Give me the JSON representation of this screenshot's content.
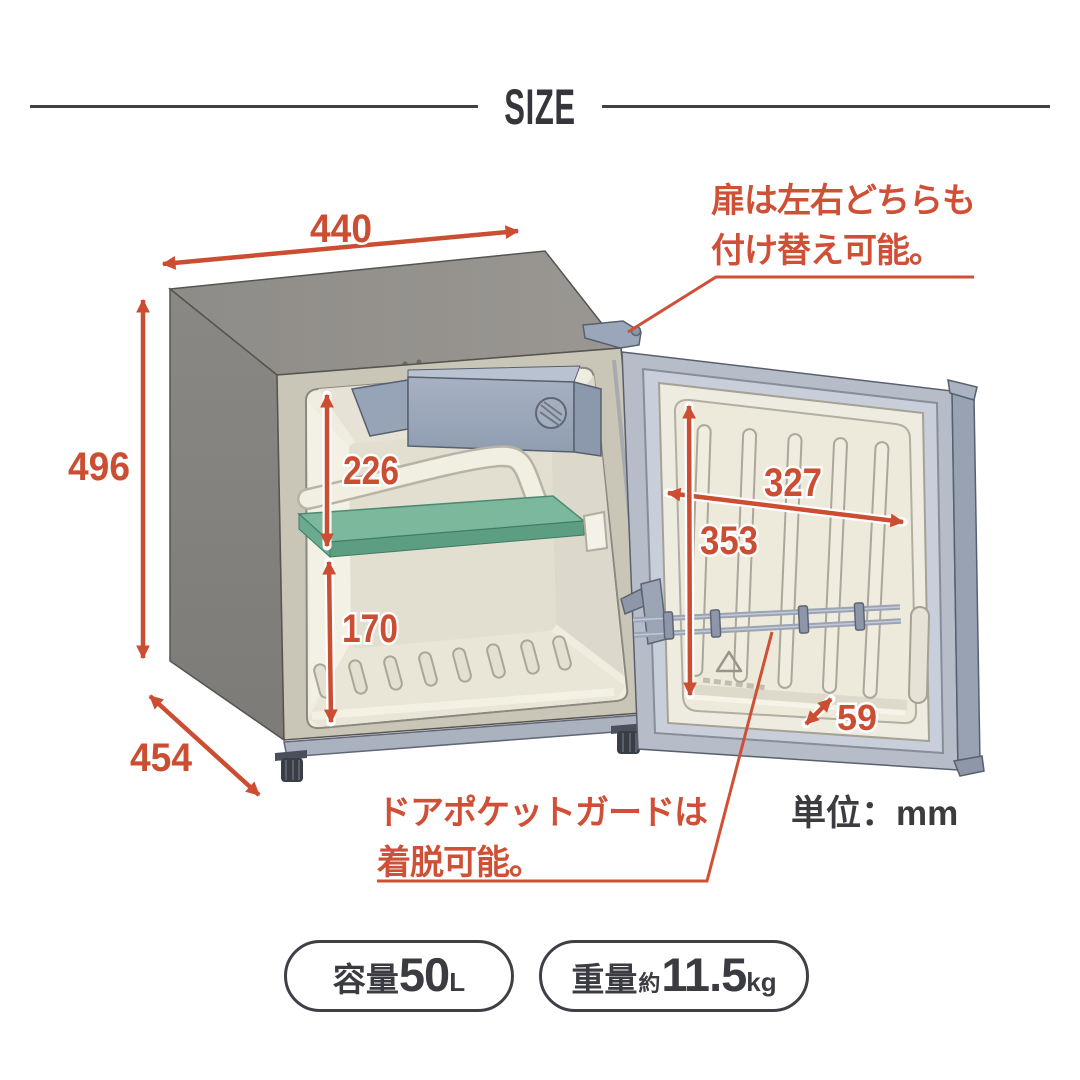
{
  "header": {
    "title": "SIZE"
  },
  "diagram": {
    "dimensions": {
      "top_width": "440",
      "body_height": "496",
      "body_depth": "454",
      "interior_upper_height": "226",
      "interior_lower_height": "170",
      "door_inner_width": "327",
      "door_inner_height": "353",
      "door_pocket_depth": "59"
    },
    "annotations": {
      "door_reversible": [
        "扉は左右どちらも",
        "付け替え可能。"
      ],
      "pocket_guard": [
        "ドアポケットガードは",
        "着脱可能。"
      ],
      "unit": "単位：mm"
    },
    "colors": {
      "accent_red": "#cc4f33",
      "text_dark": "#3a3a40",
      "cabinet_gray": "#8d8b87",
      "steel_blue": "#a6afbf",
      "interior_cream": "#efecdf",
      "shelf_green": "#79b69a"
    }
  },
  "badges": {
    "capacity": {
      "label": "容量",
      "value": "50",
      "unit": "L"
    },
    "weight": {
      "label": "重量",
      "approx": "約",
      "value": "11.5",
      "unit": "kg"
    }
  }
}
